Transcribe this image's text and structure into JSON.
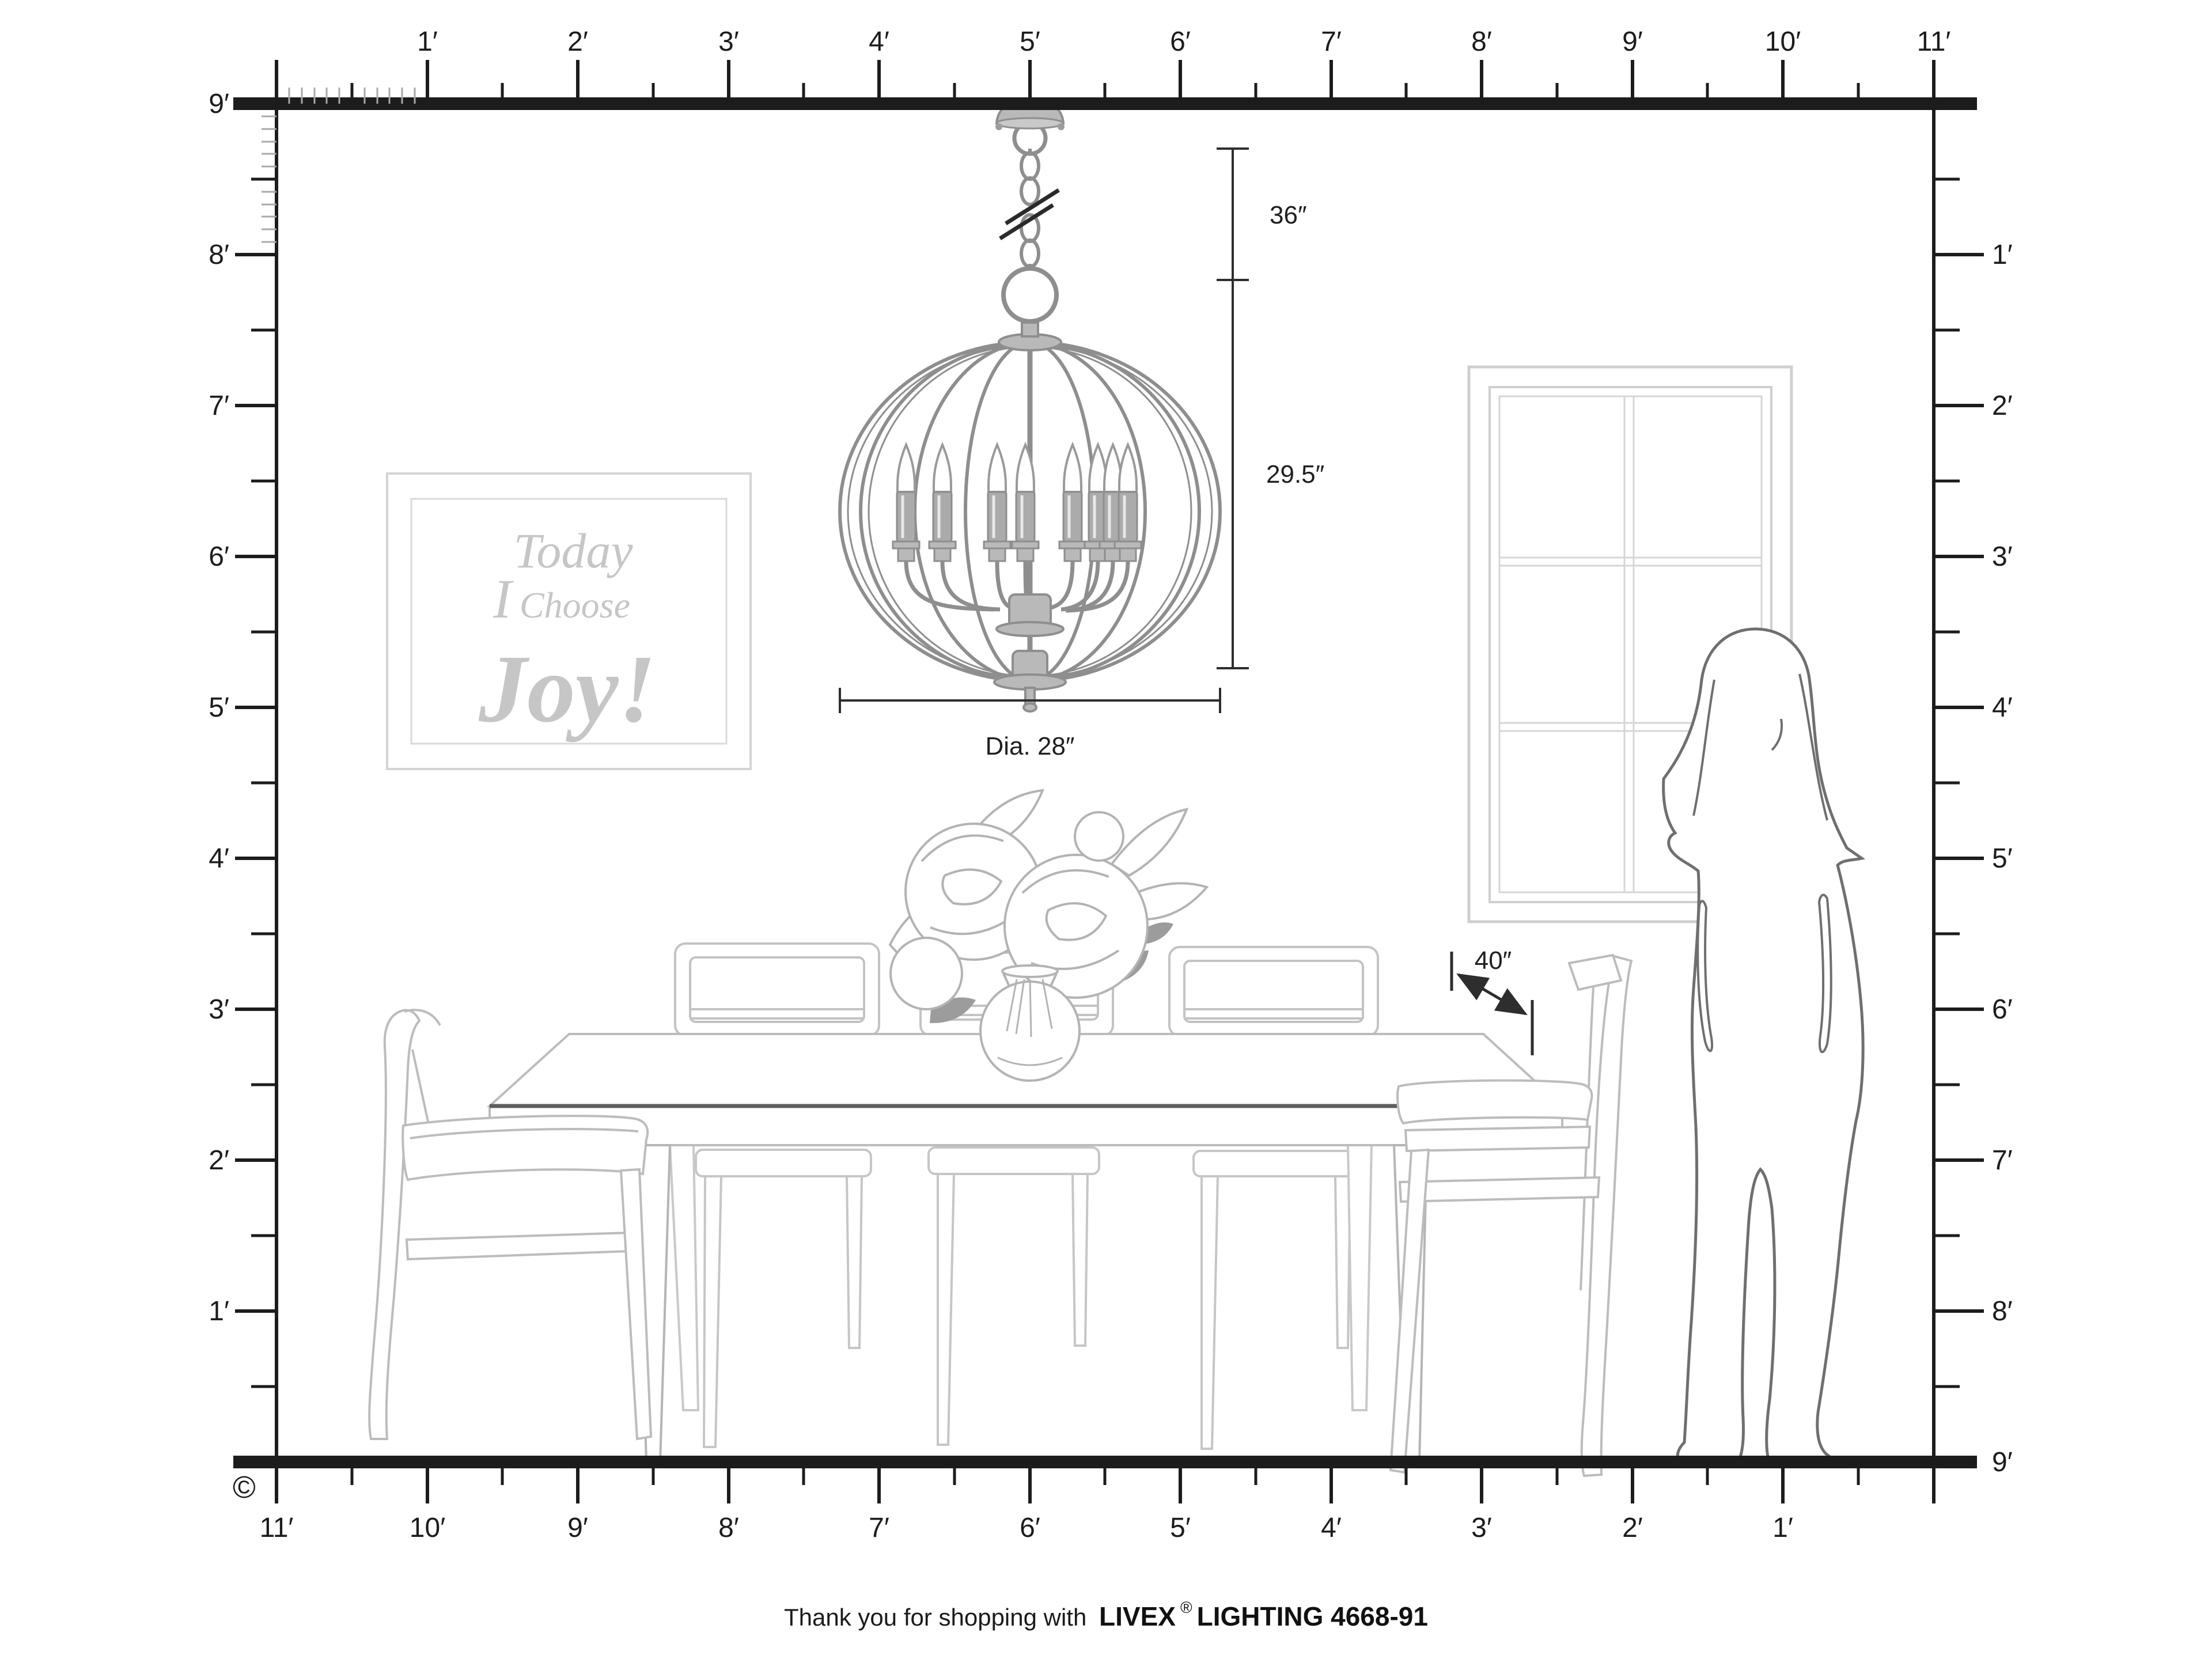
{
  "title": "Room scale diagram for Livex Lighting 4668-91 globe chandelier",
  "colors": {
    "ink": "#1c1c1c",
    "dimension": "#2e2e2e",
    "furniture_line": "#bcbcbc",
    "window_line": "#cfcfcf",
    "art_text": "#c6c6c6",
    "metal_stroke": "#8e8e8e",
    "metal_fill": "#b9b9b9",
    "silhouette_line": "#6f6f6f",
    "background": "#ffffff"
  },
  "rulers": {
    "top": [
      "1′",
      "2′",
      "3′",
      "4′",
      "5′",
      "6′",
      "7′",
      "8′",
      "9′",
      "10′",
      "11′"
    ],
    "left": [
      "9′",
      "8′",
      "7′",
      "6′",
      "5′",
      "4′",
      "3′",
      "2′",
      "1′"
    ],
    "right": [
      "1′",
      "2′",
      "3′",
      "4′",
      "5′",
      "6′",
      "7′",
      "8′",
      "9′"
    ],
    "bottom": [
      "11′",
      "10′",
      "9′",
      "8′",
      "7′",
      "6′",
      "5′",
      "4′",
      "3′",
      "2′",
      "1′"
    ]
  },
  "dimensions": {
    "chain_length": "36″",
    "fixture_height": "29.5″",
    "diameter": "Dia. 28″",
    "table_width": "40″"
  },
  "wall_art": {
    "line1": "Today",
    "line2_word1": "I",
    "line2_word2": "Choose",
    "line3": "Joy!"
  },
  "footer": {
    "message": "Thank you for shopping with ",
    "brand": "LIVEX",
    "registered_mark": "®",
    "product": "LIGHTING 4668-91",
    "copyright_symbol": "©"
  }
}
